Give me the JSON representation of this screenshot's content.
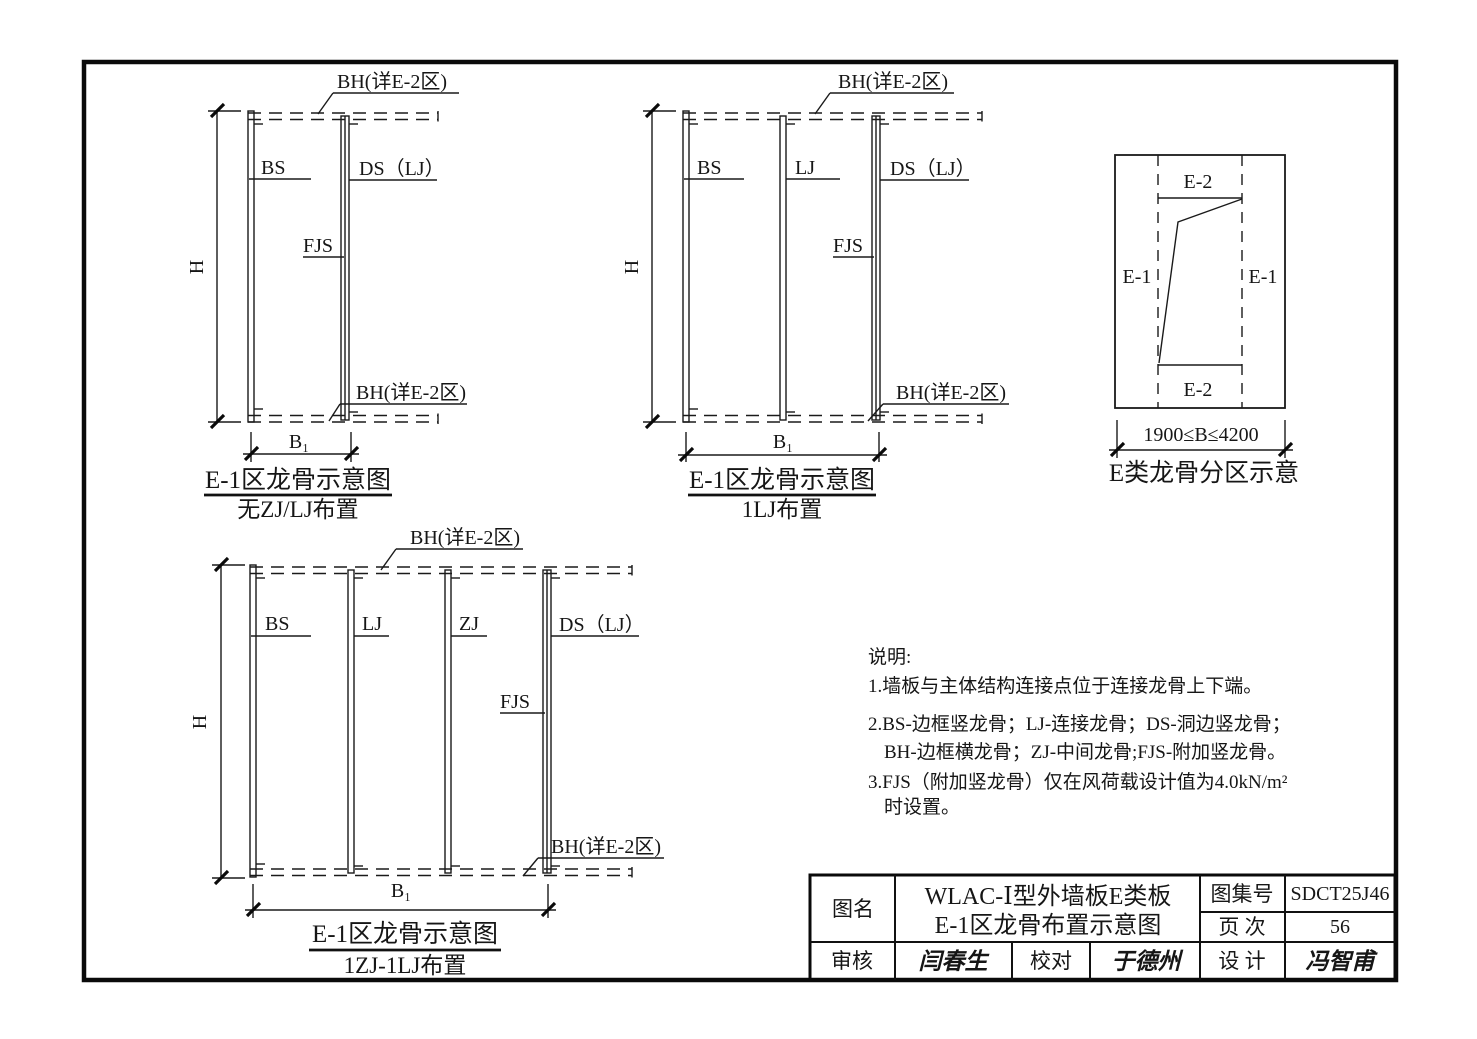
{
  "diagrams": [
    {
      "bh_top": "BH(详E-2区)",
      "bh_bottom": "BH(详E-2区)",
      "height_dim": "H",
      "width_dim": "B₁",
      "studs": {
        "bs": "BS",
        "ds": "DS（LJ）",
        "fjs": "FJS"
      },
      "title": "E-1区龙骨示意图",
      "subtitle": "无ZJ/LJ布置"
    },
    {
      "bh_top": "BH(详E-2区)",
      "bh_bottom": "BH(详E-2区)",
      "height_dim": "H",
      "width_dim": "B₁",
      "studs": {
        "bs": "BS",
        "lj": "LJ",
        "ds": "DS（LJ）",
        "fjs": "FJS"
      },
      "title": "E-1区龙骨示意图",
      "subtitle": "1LJ布置"
    },
    {
      "bh_top": "BH(详E-2区)",
      "bh_bottom": "BH(详E-2区)",
      "height_dim": "H",
      "width_dim": "B₁",
      "studs": {
        "bs": "BS",
        "lj": "LJ",
        "zj": "ZJ",
        "ds": "DS（LJ）",
        "fjs": "FJS"
      },
      "title": "E-1区龙骨示意图",
      "subtitle": "1ZJ-1LJ布置"
    }
  ],
  "zone_diagram": {
    "zones": {
      "top": "E-2",
      "left": "E-1",
      "right": "E-1",
      "bottom": "E-2"
    },
    "width_dim": "1900≤B≤4200",
    "title": "E类龙骨分区示意"
  },
  "notes": {
    "heading": "说明:",
    "lines": [
      "1.墙板与主体结构连接点位于连接龙骨上下端。",
      "2.BS-边框竖龙骨；LJ-连接龙骨；DS-洞边竖龙骨；",
      "BH-边框横龙骨；ZJ-中间龙骨;FJS-附加竖龙骨。",
      "3.FJS（附加竖龙骨）仅在风荷载设计值为4.0kN/m²",
      "时设置。"
    ]
  },
  "title_block": {
    "drawing_name_label": "图名",
    "drawing_name_line1": "WLAC-Ⅰ型外墙板E类板",
    "drawing_name_line2": "E-1区龙骨布置示意图",
    "atlas_no_label": "图集号",
    "atlas_no": "SDCT25J46",
    "page_label": "页 次",
    "page_number": "56",
    "review_label": "审核",
    "review_signature": "闫春生",
    "check_label": "校对",
    "check_signature": "于德州",
    "design_label": "设 计",
    "design_signature": "冯智甫"
  },
  "colors": {
    "line": "#1a1a1a",
    "paper": "#ffffff"
  }
}
